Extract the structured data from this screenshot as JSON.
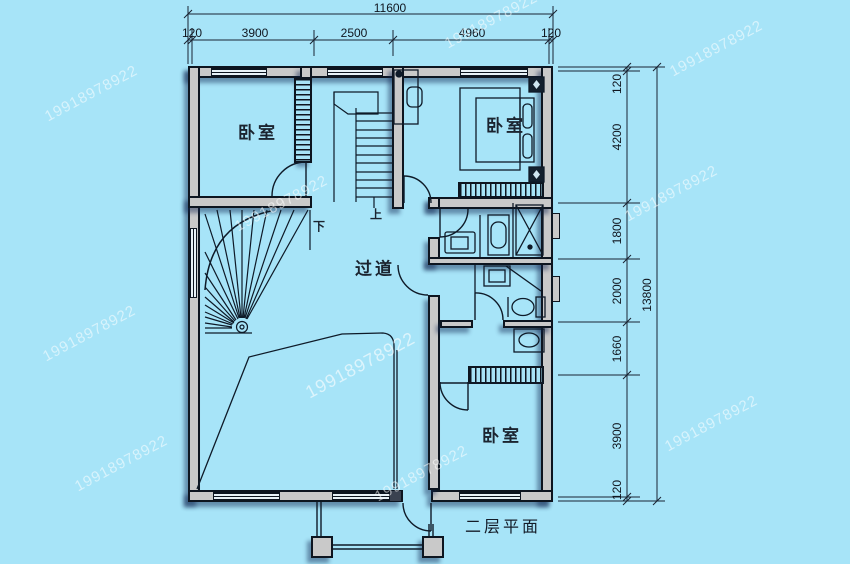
{
  "title": "二层平面",
  "watermark": "19918978922",
  "rooms": {
    "bedroom_top_left": "卧室",
    "bedroom_top_right": "卧室",
    "bedroom_bottom_right": "卧室",
    "hallway": "过道"
  },
  "stairs": {
    "up_label": "上",
    "down_label": "下"
  },
  "dimensions": {
    "top": {
      "total": "11600",
      "segments": [
        "120",
        "3900",
        "2500",
        "4960",
        "120"
      ]
    },
    "right": {
      "total": "13800",
      "segments": [
        "120",
        "4200",
        "1800",
        "2000",
        "1660",
        "3900",
        "120"
      ]
    }
  }
}
